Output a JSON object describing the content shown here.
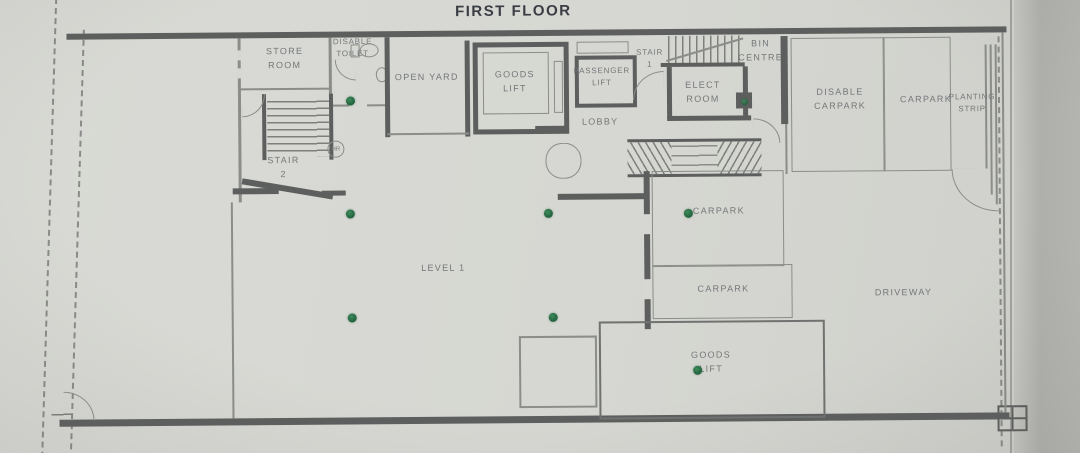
{
  "title": "FIRST FLOOR",
  "colors": {
    "paper": "#d6d7d2",
    "paper_edge": "#b0b1ad",
    "wall": "#5d5f5e",
    "line": "#8b8d8a",
    "label": "#74777a",
    "title_ink": "#3a3d44",
    "marker": "#20603b"
  },
  "rooms": {
    "store_room": "STORE\nROOM",
    "disable_toilet": "DISABLE\nTOILET",
    "open_yard": "OPEN YARD",
    "goods_lift_top": "GOODS\nLIFT",
    "passenger_lift": "PASSENGER\nLIFT",
    "stair_1": "STAIR\n1",
    "lobby": "LOBBY",
    "elect_room": "ELECT\nROOM",
    "bin_centre": "BIN\nCENTRE",
    "disable_carpark": "DISABLE\nCARPARK",
    "carpark_right": "CARPARK",
    "planting_strip": "PLANTING\nSTRIP",
    "stair_2": "STAIR\n2",
    "hose_reel": "HR",
    "level_1": "LEVEL 1",
    "carpark_mid": "CARPARK",
    "carpark_lower": "CARPARK",
    "driveway": "DRIVEWAY",
    "goods_lift_bottom": "GOODS\nLIFT"
  }
}
